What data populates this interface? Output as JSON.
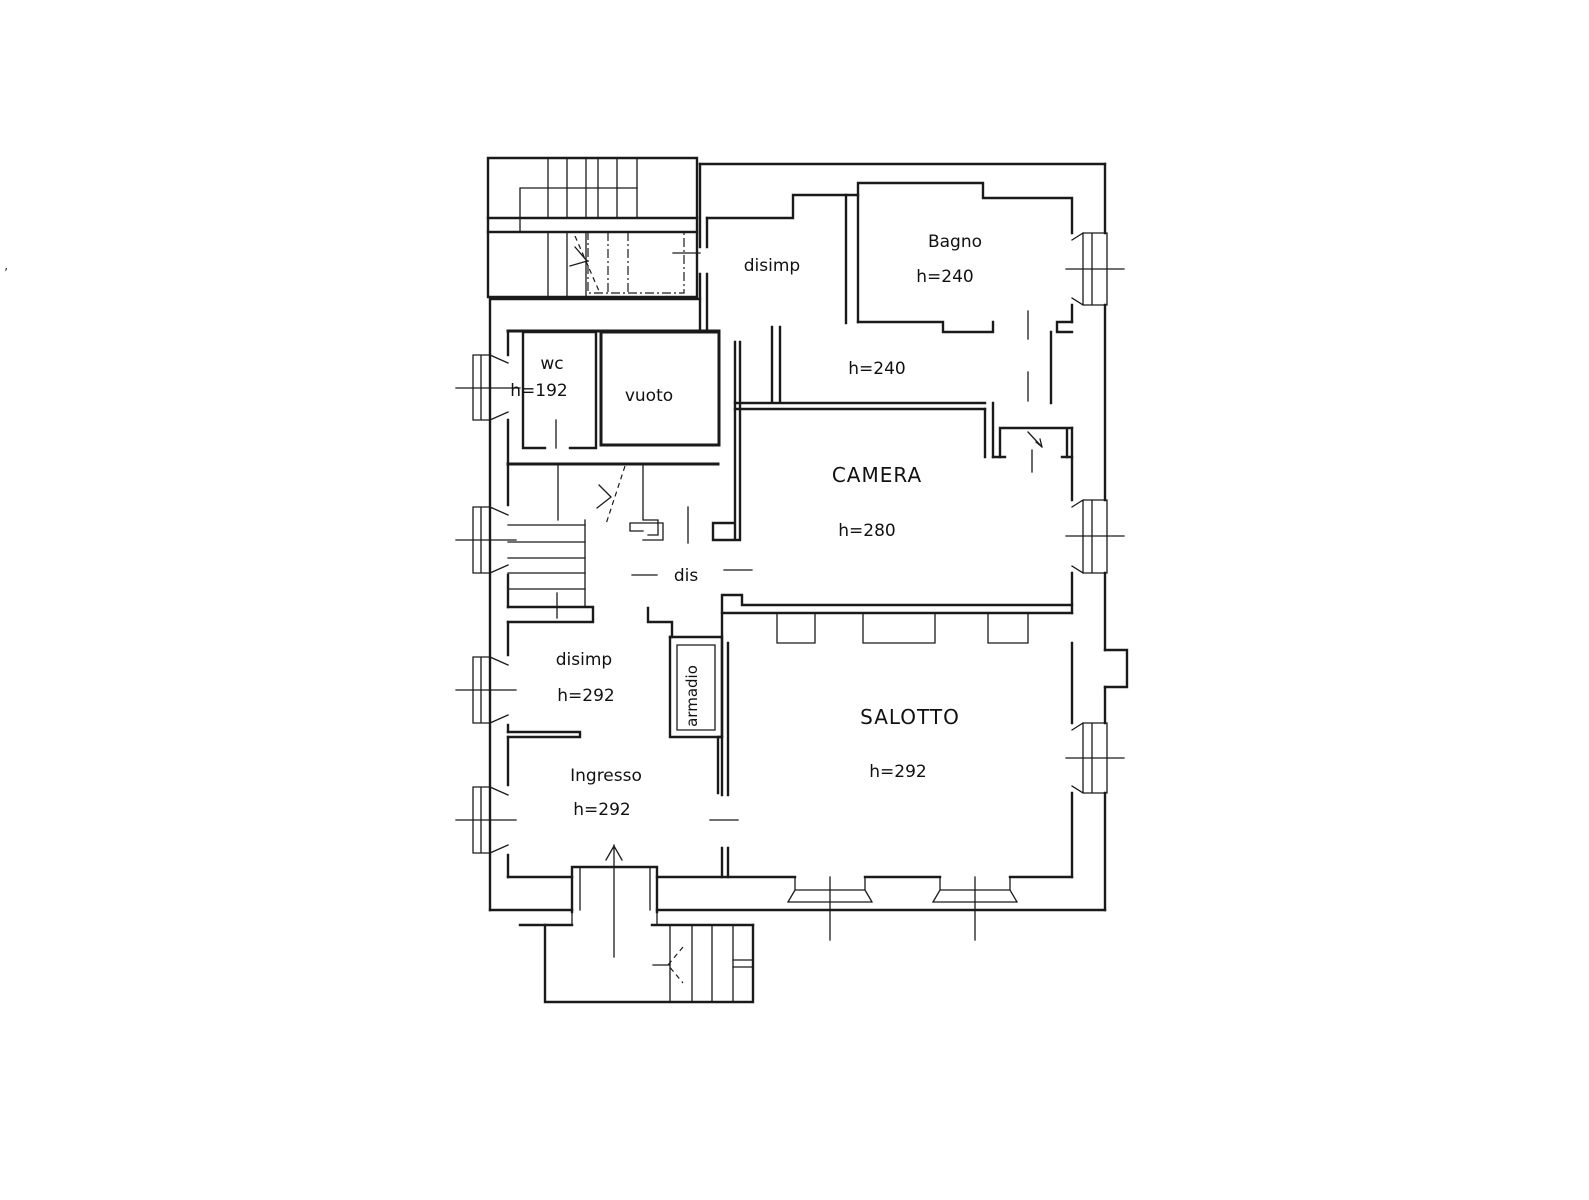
{
  "plan": {
    "type": "floor-plan",
    "language": "it",
    "labels": {
      "disimp_upper": "disimp",
      "bagno": "Bagno",
      "bagno_h": "h=240",
      "corridor_h": "h=240",
      "wc": "wc",
      "wc_h": "h=192",
      "vuoto": "vuoto",
      "camera": "CAMERA",
      "camera_h": "h=280",
      "dis": "dis",
      "disimp_lower": "disimp",
      "disimp_lower_h": "h=292",
      "armadio": "armadio",
      "salotto": "SALOTTO",
      "salotto_h": "h=292",
      "ingresso": "Ingresso",
      "ingresso_h": "h=292",
      "stray_mark": "’"
    },
    "rooms": [
      {
        "name": "disimp-upper",
        "label": "disimp"
      },
      {
        "name": "bagno",
        "label": "Bagno",
        "height": "h=240"
      },
      {
        "name": "corridoio",
        "height": "h=240"
      },
      {
        "name": "wc",
        "label": "wc",
        "height": "h=192"
      },
      {
        "name": "vuoto",
        "label": "vuoto"
      },
      {
        "name": "camera",
        "label": "CAMERA",
        "height": "h=280"
      },
      {
        "name": "dis",
        "label": "dis"
      },
      {
        "name": "disimp-lower",
        "label": "disimp",
        "height": "h=292"
      },
      {
        "name": "armadio",
        "label": "armadio"
      },
      {
        "name": "salotto",
        "label": "SALOTTO",
        "height": "h=292"
      },
      {
        "name": "ingresso",
        "label": "Ingresso",
        "height": "h=292"
      }
    ],
    "line_color": "#1a1a1a",
    "background_color": "#ffffff"
  }
}
